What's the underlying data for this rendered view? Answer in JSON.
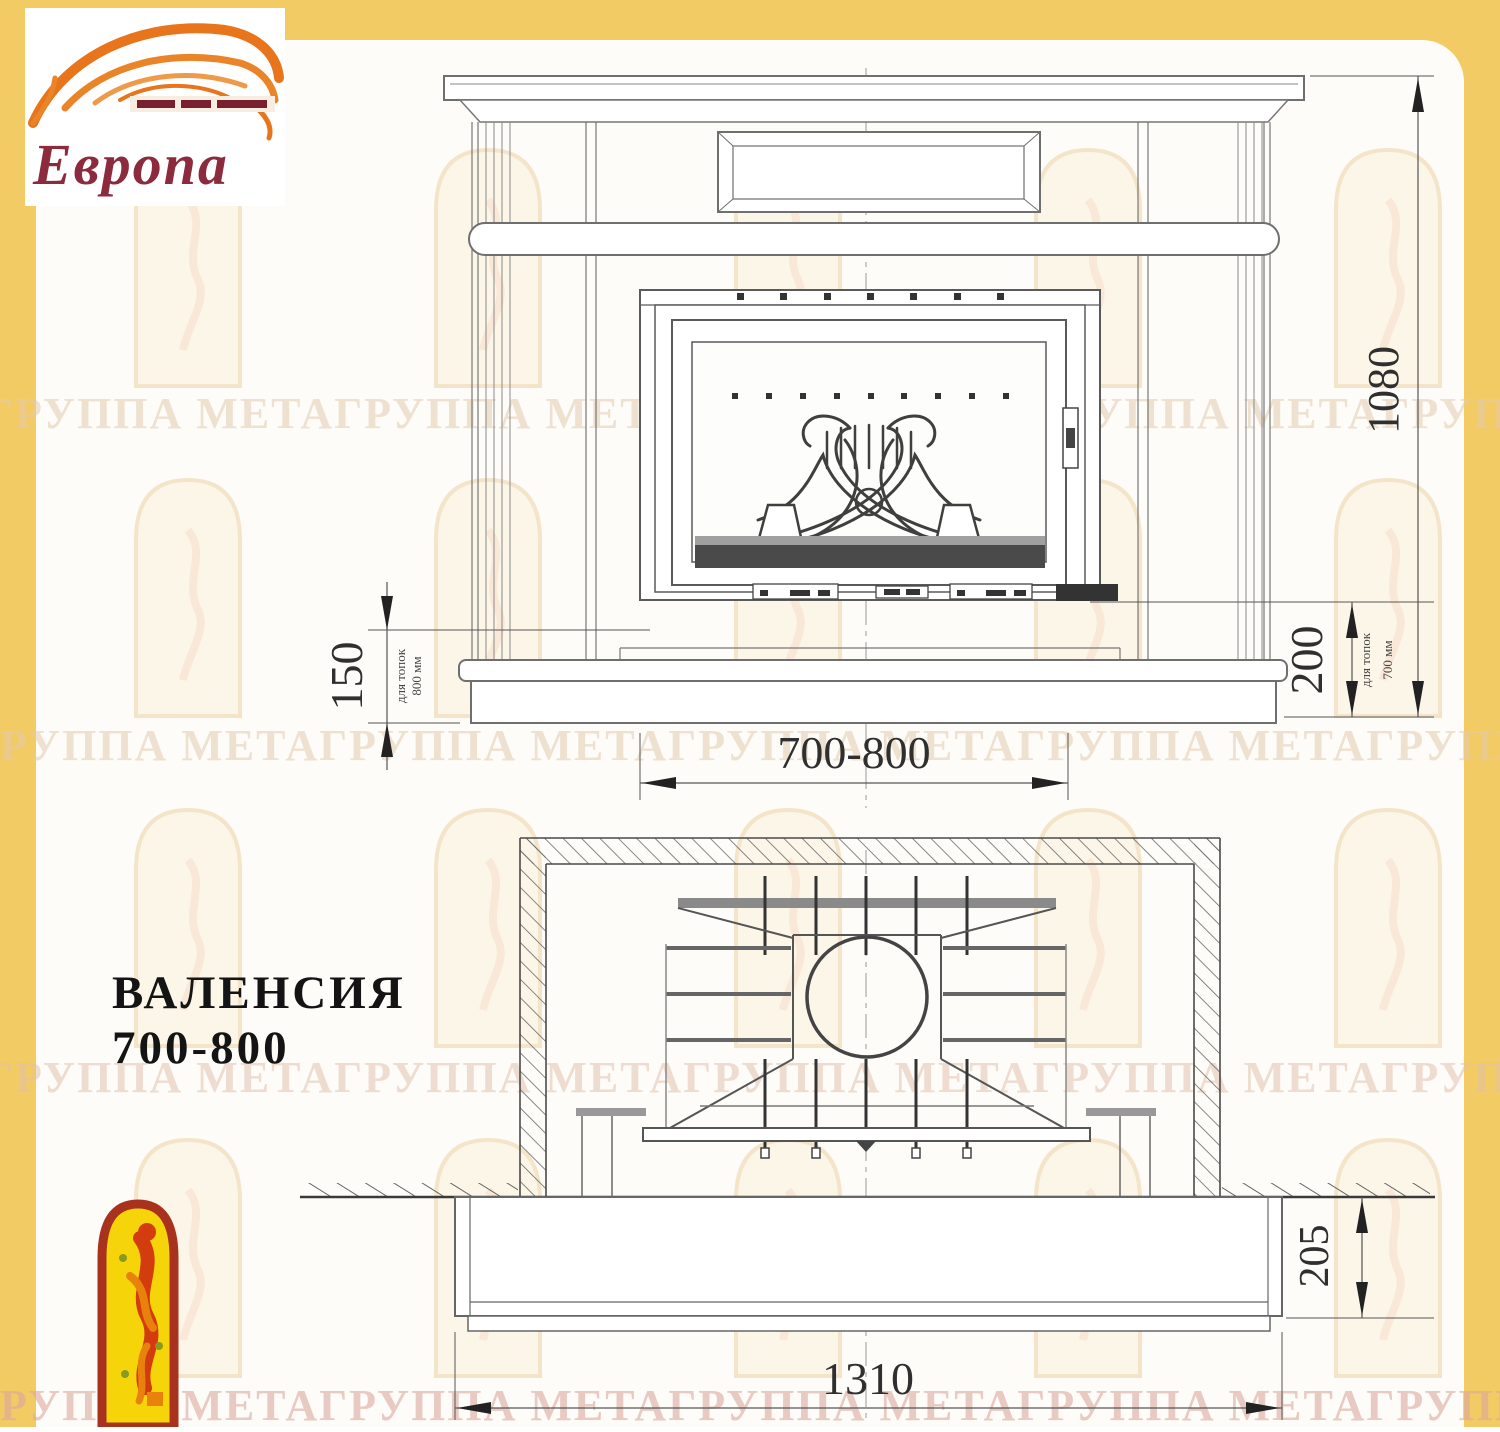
{
  "logo": {
    "brand": "Европа"
  },
  "title": {
    "line1": "ВАЛЕНСИЯ",
    "line2": "700-800"
  },
  "front_view": {
    "dim_height": "1080",
    "dim_left": "150",
    "dim_left_note1": "для топок",
    "dim_left_note2": "800 мм",
    "dim_right": "200",
    "dim_right_note1": "для топок",
    "dim_right_note2": "700 мм",
    "dim_firebox_width": "700-800"
  },
  "plan_view": {
    "dim_hearth_depth": "205",
    "dim_total_width": "1310"
  },
  "watermark": {
    "text": "ГРУППА МЕТАГРУППА МЕТАГРУППА МЕТАГРУППА МЕТАГРУППА МЕТА"
  },
  "colors": {
    "frame_yellow": "#f3cb64",
    "flame_orange": "#e8751c",
    "logo_text": "#8c2a3e",
    "emblem_red": "#a8321e",
    "emblem_yellow": "#f5d50a",
    "drawing_line": "#6f6f6f",
    "dim_text": "#2f2f2f"
  }
}
